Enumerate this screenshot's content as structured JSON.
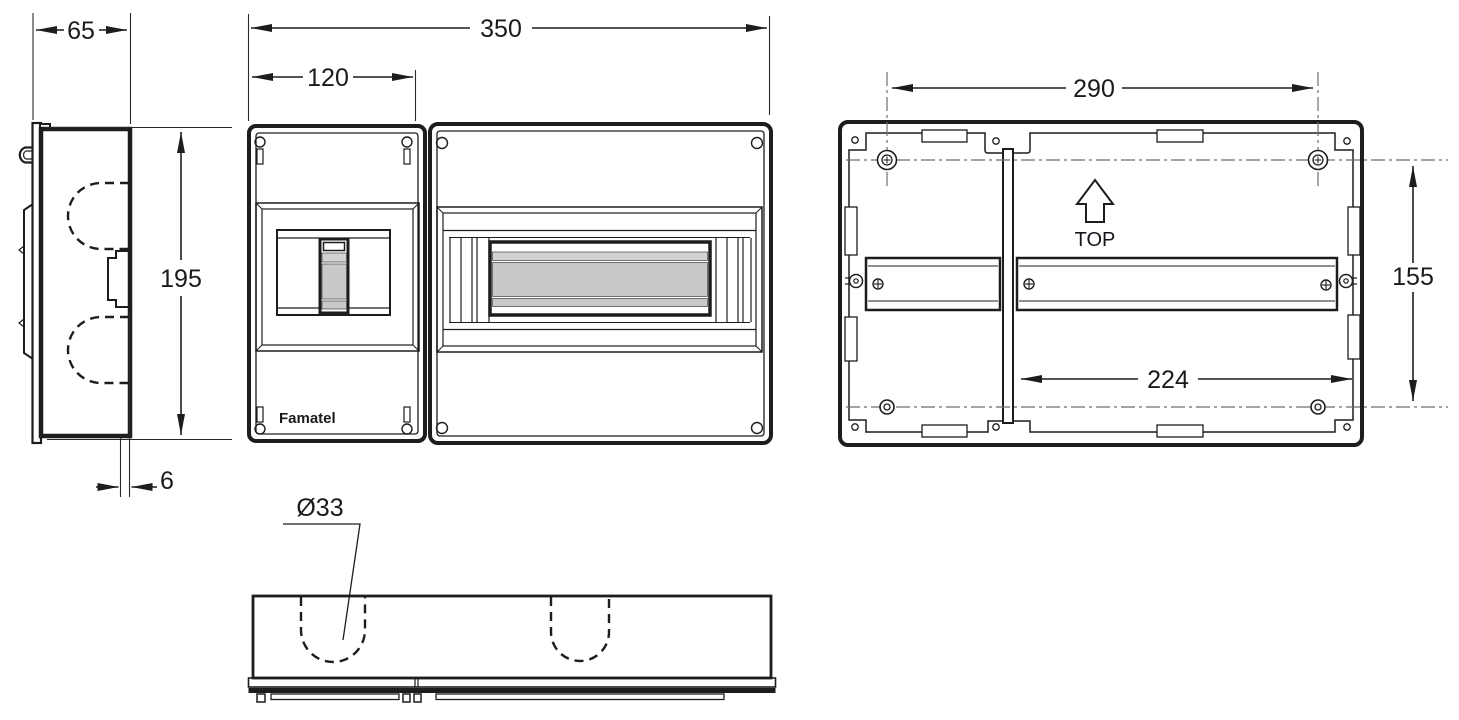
{
  "drawing": {
    "brand_label": "Famatel",
    "orientation_label": "TOP",
    "dimensions": {
      "side_total_depth": "65",
      "side_height": "195",
      "lid_protrusion": "6",
      "front_total_width": "350",
      "front_left_panel_width": "120",
      "knockout_diameter": "Ø33",
      "mounting_holes_horizontal_spacing": "290",
      "mounting_holes_vertical_spacing": "155",
      "din_rail_clear_width": "224"
    },
    "icons": {
      "orientation_arrow": "up-arrow-outline",
      "mounting_screw": "cross-head-screw",
      "knockout": "dashed-knockout-u"
    },
    "colors": {
      "line": "#1d1d1d",
      "shade_grey": "#c9c9c9",
      "centerline_grey": "#6e6e6e",
      "background": "#ffffff"
    }
  }
}
